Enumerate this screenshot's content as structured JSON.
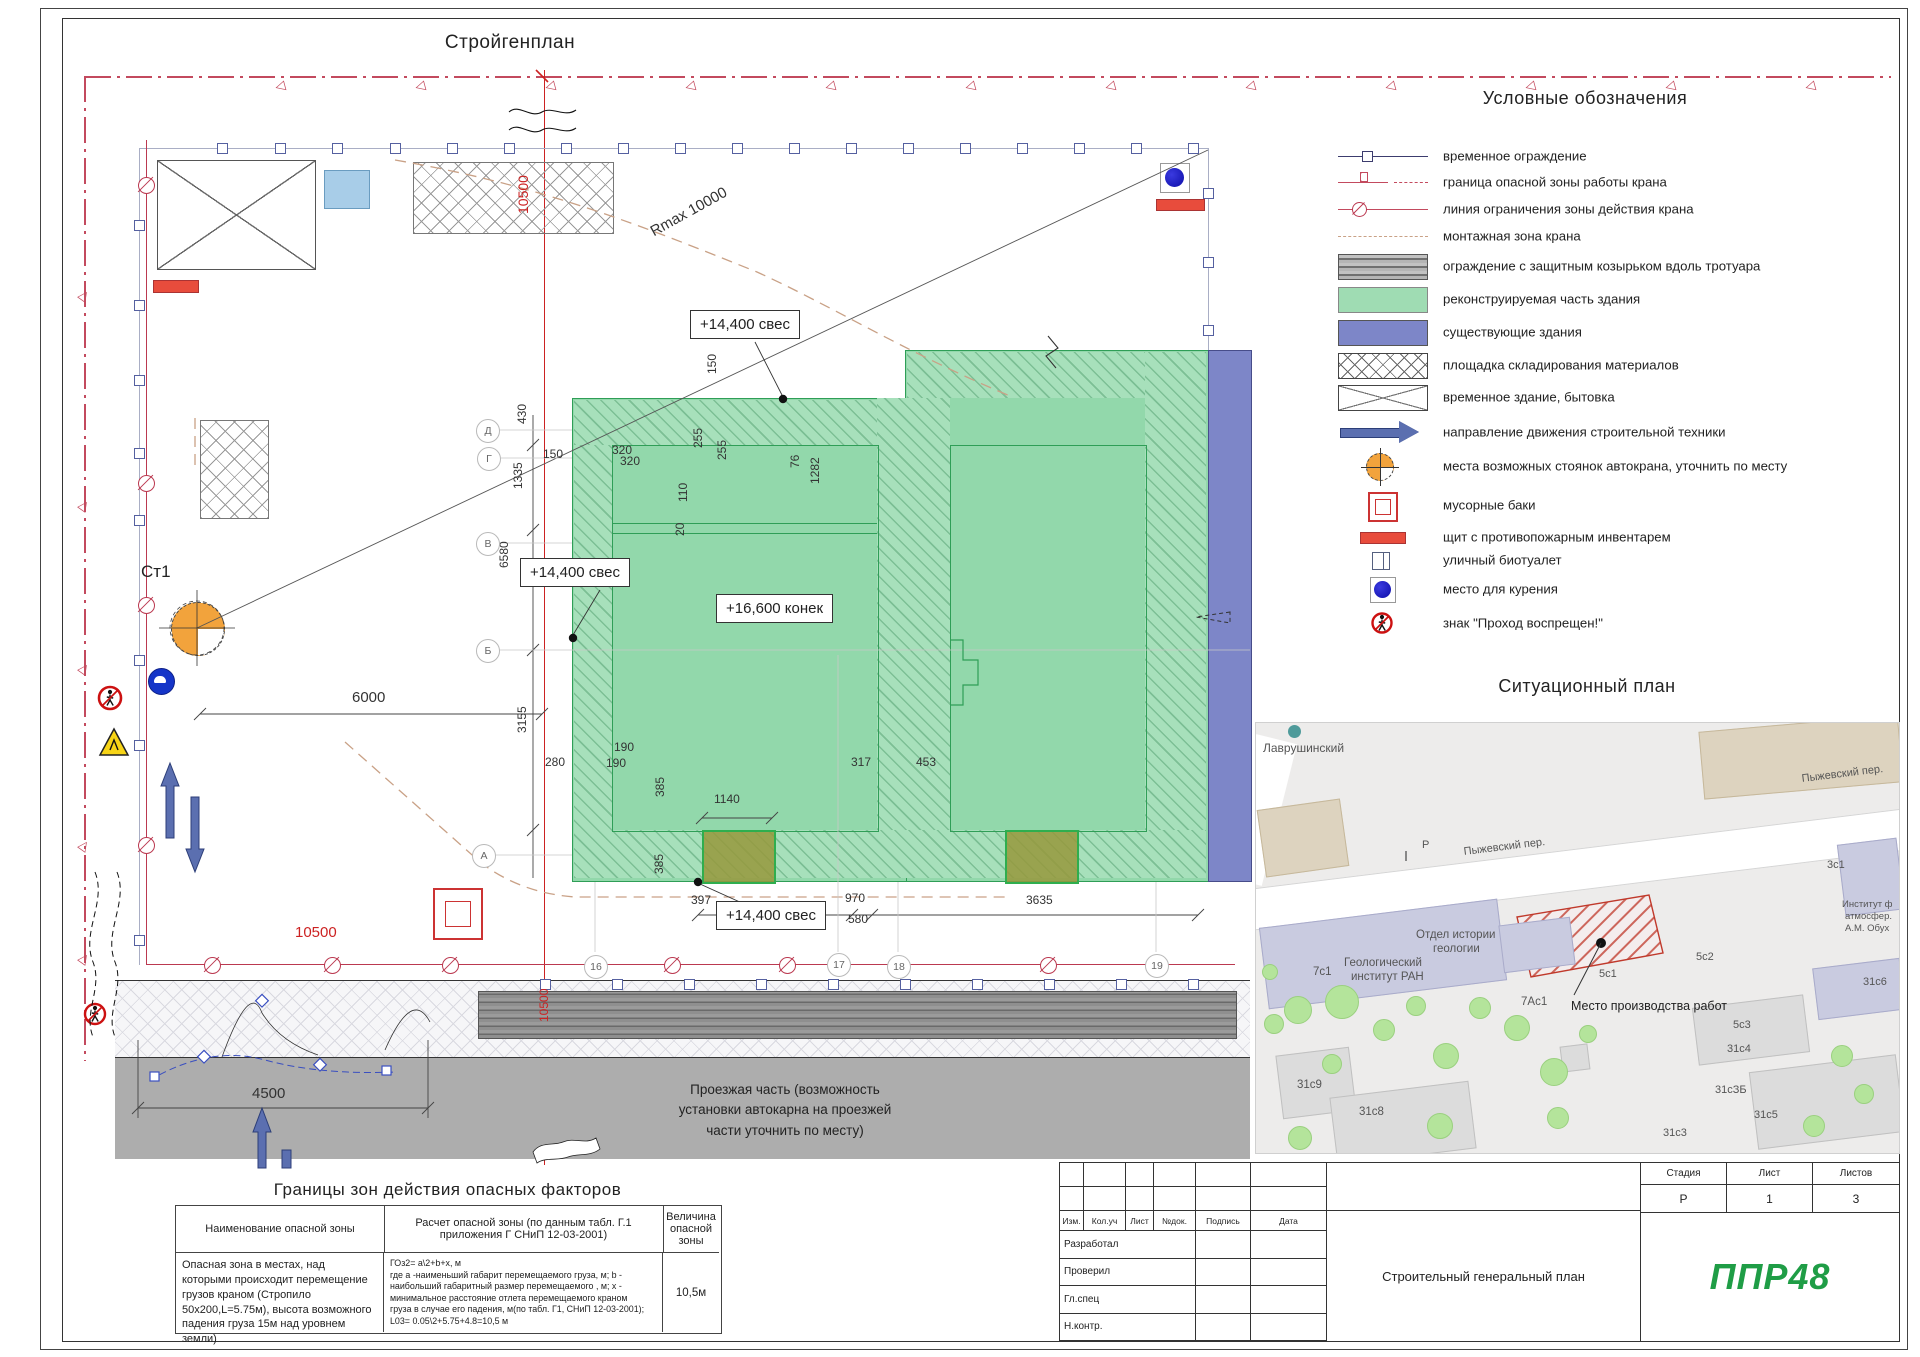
{
  "titles": {
    "plan": "Стройгенплан",
    "legend": "Условные обозначения",
    "situational": "Ситуационный план",
    "hazard": "Границы зон действия опасных факторов"
  },
  "legend": {
    "items": [
      {
        "icon": "fence-line",
        "label": "временное ограждение",
        "y": 8,
        "h": 20
      },
      {
        "icon": "danger-boundary-line",
        "label": "граница опасной зоны работы крана",
        "y": 34,
        "h": 20
      },
      {
        "icon": "crane-limit-line",
        "label": "линия ограничения зоны действия крана",
        "y": 61,
        "h": 20
      },
      {
        "icon": "montage-zone-line",
        "label": "монтажная зона крана",
        "y": 88,
        "h": 20
      },
      {
        "icon": "hoarding",
        "label": "ограждение с защитным козырьком вдоль тротуара",
        "y": 116,
        "h": 24
      },
      {
        "icon": "reconstruction",
        "label": "реконструируемая часть здания",
        "y": 149,
        "h": 24
      },
      {
        "icon": "existing",
        "label": "существующие здания",
        "y": 182,
        "h": 24
      },
      {
        "icon": "storage",
        "label": "площадка складирования материалов",
        "y": 215,
        "h": 24
      },
      {
        "icon": "tempbuilding",
        "label": "временное здание, бытовка",
        "y": 247,
        "h": 24
      },
      {
        "icon": "arrow",
        "label": "направление движения строительной техники",
        "y": 282,
        "h": 24
      },
      {
        "icon": "crane-parking",
        "label": "места возможных стоянок автокрана, уточнить по месту",
        "y": 312,
        "h": 32
      },
      {
        "icon": "trash",
        "label": "мусорные баки",
        "y": 350,
        "h": 34
      },
      {
        "icon": "fire-shield",
        "label": "щит с противопожарным инвентарем",
        "y": 390,
        "h": 18
      },
      {
        "icon": "biotoilet",
        "label": "уличный биотуалет",
        "y": 412,
        "h": 20
      },
      {
        "icon": "smoking",
        "label": "место для курения",
        "y": 438,
        "h": 26
      },
      {
        "icon": "no-pass",
        "label": "знак \"Проход воспрещен!\"",
        "y": 472,
        "h": 26
      }
    ]
  },
  "plan": {
    "crane_label": "Ст1",
    "radius_label": "Rmax 10000",
    "levels": [
      "+14,400 свес",
      "+14,400 свес",
      "+16,600 конек",
      "+14,400 свес"
    ],
    "road_note": "Проезжая часть (возможность\nустановки автокарна на проезжей\nчасти уточнить по месту)",
    "labels": [
      {
        "t": "430",
        "x": 516,
        "y": 424,
        "r": -90
      },
      {
        "t": "1335",
        "x": 512,
        "y": 489,
        "r": -90
      },
      {
        "t": "6580",
        "x": 498,
        "y": 568,
        "r": -90
      },
      {
        "t": "1640",
        "x": 520,
        "y": 585,
        "r": -90
      },
      {
        "t": "3155",
        "x": 516,
        "y": 733,
        "r": -90
      },
      {
        "t": "150",
        "x": 543,
        "y": 448
      },
      {
        "t": "150",
        "x": 706,
        "y": 374,
        "r": -90
      },
      {
        "t": "320",
        "x": 612,
        "y": 444
      },
      {
        "t": "320",
        "x": 620,
        "y": 455
      },
      {
        "t": "255",
        "x": 692,
        "y": 448,
        "r": -90
      },
      {
        "t": "255",
        "x": 716,
        "y": 460,
        "r": -90
      },
      {
        "t": "110",
        "x": 677,
        "y": 502,
        "r": -90
      },
      {
        "t": "20",
        "x": 674,
        "y": 536,
        "r": -90
      },
      {
        "t": "76",
        "x": 789,
        "y": 468,
        "r": -90
      },
      {
        "t": "1282",
        "x": 809,
        "y": 484,
        "r": -90
      },
      {
        "t": "280",
        "x": 545,
        "y": 756
      },
      {
        "t": "190",
        "x": 614,
        "y": 741
      },
      {
        "t": "190",
        "x": 606,
        "y": 757
      },
      {
        "t": "385",
        "x": 654,
        "y": 797,
        "r": -90
      },
      {
        "t": "385",
        "x": 653,
        "y": 874,
        "r": -90
      },
      {
        "t": "1140",
        "x": 714,
        "y": 793
      },
      {
        "t": "317",
        "x": 851,
        "y": 756
      },
      {
        "t": "453",
        "x": 916,
        "y": 756
      },
      {
        "t": "397",
        "x": 691,
        "y": 894
      },
      {
        "t": "970",
        "x": 845,
        "y": 892
      },
      {
        "t": "3635",
        "x": 1026,
        "y": 894
      },
      {
        "t": "580",
        "x": 848,
        "y": 913
      },
      {
        "t": "6000",
        "x": 352,
        "y": 690,
        "cls": "d15"
      },
      {
        "t": "4500",
        "x": 252,
        "y": 1086,
        "cls": "d15"
      },
      {
        "t": "10500",
        "x": 295,
        "y": 925,
        "cls": "red d15"
      },
      {
        "t": "10500",
        "x": 516,
        "y": 214,
        "r": -90,
        "cls": "red d14"
      },
      {
        "t": "10500",
        "x": 538,
        "y": 1022,
        "r": -90,
        "cls": "red"
      },
      {
        "t": "Rmax 10000",
        "x": 648,
        "y": 226,
        "r": -29,
        "cls": "d15"
      },
      {
        "t": "Ст1",
        "x": 141,
        "y": 563,
        "cls": "d17"
      }
    ],
    "grid_letters": [
      {
        "t": "Д",
        "x": 487,
        "y": 430
      },
      {
        "t": "Г",
        "x": 488,
        "y": 458
      },
      {
        "t": "В",
        "x": 487,
        "y": 543
      },
      {
        "t": "Б",
        "x": 487,
        "y": 650
      },
      {
        "t": "А",
        "x": 483,
        "y": 855
      }
    ],
    "grid_numbers": [
      {
        "t": "16",
        "x": 595,
        "y": 966
      },
      {
        "t": "17",
        "x": 838,
        "y": 964
      },
      {
        "t": "18",
        "x": 898,
        "y": 966
      },
      {
        "t": "19",
        "x": 1156,
        "y": 965
      }
    ],
    "deco": {
      "top_flags": [
        275,
        415,
        545,
        685,
        825,
        965,
        1105,
        1245,
        1385,
        1525,
        1665,
        1805
      ],
      "left_flags": [
        290,
        500,
        663,
        840,
        953
      ],
      "fence_top_x": [
        222,
        280,
        337,
        395,
        452,
        509,
        566,
        623,
        680,
        737,
        794,
        851,
        908,
        965,
        1022,
        1079,
        1136,
        1193
      ],
      "fence_right_y": [
        193,
        262,
        330
      ],
      "fence_left_y": [
        225,
        305,
        380,
        453,
        520,
        660,
        745,
        940
      ],
      "strip_sq_x": [
        545,
        617,
        689,
        761,
        833,
        905,
        977,
        1049,
        1121,
        1193
      ],
      "limit_circ_left_y": [
        185,
        483,
        605,
        845
      ],
      "limit_circ_bottom_x": [
        212,
        332,
        450,
        672,
        787,
        1048
      ]
    }
  },
  "map": {
    "labels": [
      {
        "t": "Лаврушинский",
        "x": 7,
        "y": 18,
        "s": 12
      },
      {
        "t": "Пыжевский пер.",
        "x": 207,
        "y": 123,
        "s": 11,
        "r": -7
      },
      {
        "t": "Пыжевский пер.",
        "x": 545,
        "y": 50,
        "s": 11,
        "r": -7
      },
      {
        "t": "P",
        "x": 166,
        "y": 116,
        "s": 11
      },
      {
        "t": "3с1",
        "x": 571,
        "y": 136,
        "s": 11
      },
      {
        "t": "Институт ф",
        "x": 586,
        "y": 176,
        "s": 9.5
      },
      {
        "t": "атмосфер.",
        "x": 589,
        "y": 188,
        "s": 9.5
      },
      {
        "t": "А.М. Обух",
        "x": 589,
        "y": 200,
        "s": 9.5
      },
      {
        "t": "Отдел истории",
        "x": 160,
        "y": 206,
        "s": 11.5
      },
      {
        "t": "геологии",
        "x": 177,
        "y": 220,
        "s": 11.5
      },
      {
        "t": "7с1",
        "x": 57,
        "y": 243,
        "s": 11.5
      },
      {
        "t": "Геологический",
        "x": 88,
        "y": 234,
        "s": 11.5
      },
      {
        "t": "институт РАН",
        "x": 95,
        "y": 248,
        "s": 11.5
      },
      {
        "t": "7Ас1",
        "x": 265,
        "y": 273,
        "s": 11.5
      },
      {
        "t": "5с2",
        "x": 440,
        "y": 228,
        "s": 11
      },
      {
        "t": "5с1",
        "x": 343,
        "y": 245,
        "s": 11
      },
      {
        "t": "Место производства работ",
        "x": 315,
        "y": 276,
        "s": 12.5,
        "dark": 1
      },
      {
        "t": "5с3",
        "x": 477,
        "y": 296,
        "s": 11
      },
      {
        "t": "31с4",
        "x": 471,
        "y": 320,
        "s": 11
      },
      {
        "t": "31с6",
        "x": 607,
        "y": 253,
        "s": 11
      },
      {
        "t": "31сЗБ",
        "x": 459,
        "y": 361,
        "s": 11
      },
      {
        "t": "31с5",
        "x": 498,
        "y": 386,
        "s": 11
      },
      {
        "t": "31с3",
        "x": 407,
        "y": 404,
        "s": 11
      },
      {
        "t": "31с9",
        "x": 41,
        "y": 356,
        "s": 11.5
      },
      {
        "t": "31с8",
        "x": 103,
        "y": 383,
        "s": 11.5
      }
    ],
    "trees": [
      [
        17,
        300,
        9
      ],
      [
        41,
        286,
        13
      ],
      [
        85,
        278,
        16
      ],
      [
        127,
        306,
        10
      ],
      [
        159,
        282,
        9
      ],
      [
        189,
        332,
        12
      ],
      [
        223,
        284,
        10
      ],
      [
        260,
        304,
        12
      ],
      [
        297,
        348,
        13
      ],
      [
        183,
        402,
        12
      ],
      [
        301,
        394,
        10
      ],
      [
        43,
        414,
        11
      ],
      [
        75,
        340,
        9
      ],
      [
        331,
        310,
        8
      ],
      [
        585,
        332,
        10
      ],
      [
        607,
        370,
        9
      ],
      [
        557,
        402,
        10
      ],
      [
        13,
        248,
        7
      ]
    ],
    "buildings": [
      {
        "x": 5,
        "y": 81,
        "w": 82,
        "h": 66,
        "r": -8,
        "k": "mb-beige"
      },
      {
        "x": 445,
        "y": 0,
        "w": 198,
        "h": 66,
        "r": -5,
        "k": "mb-beige"
      },
      {
        "x": 7,
        "y": 190,
        "w": 238,
        "h": 80,
        "r": -7,
        "k": "mb-lav"
      },
      {
        "x": 245,
        "y": 198,
        "w": 70,
        "h": 46,
        "r": -7,
        "k": "mb-lav"
      },
      {
        "x": 585,
        "y": 118,
        "w": 58,
        "h": 70,
        "r": -7,
        "k": "mb-lav"
      },
      {
        "x": 559,
        "y": 240,
        "w": 86,
        "h": 50,
        "r": -7,
        "k": "mb-lav"
      },
      {
        "x": 439,
        "y": 278,
        "w": 110,
        "h": 56,
        "r": -7,
        "k": "mb-gray"
      },
      {
        "x": 497,
        "y": 340,
        "w": 146,
        "h": 76,
        "r": -7,
        "k": "mb-gray"
      },
      {
        "x": 23,
        "y": 328,
        "w": 72,
        "h": 62,
        "r": -7,
        "k": "mb-gray"
      },
      {
        "x": 77,
        "y": 366,
        "w": 138,
        "h": 66,
        "r": -7,
        "k": "mb-gray"
      },
      {
        "x": 305,
        "y": 322,
        "w": 26,
        "h": 24,
        "r": -7,
        "k": "mb-gray"
      }
    ]
  },
  "hazard_table": {
    "headers": [
      "Наименование опасной зоны",
      "Расчет опасной зоны (по данным табл. Г.1\nприложения Г СНиП 12-03-2001)",
      "Величина\nопасной\nзоны"
    ],
    "row": {
      "name": "Опасная зона в местах, над которыми происходит перемещение грузов краном (Стропило 50х200,L=5.75м), высота возможного падения груза 15м над уровнем земли)",
      "calc": "ГОз2= а\\2+b+х, м\nгде а -наименьший габарит перемещаемого груза, м; b -\nнаибольший габаритный размер перемещаемого , м; х -\nминимальное расстояние отлета перемещаемого краном\nгруза в случае его падения, м(по табл. Г1, СНиП 12-03-2001);\nL03= 0.05\\2+5.75+4.8=10,5 м",
      "value": "10,5м"
    }
  },
  "stamp": {
    "header_cols": [
      "Изм.",
      "Кол.уч",
      "Лист",
      "№док.",
      "Подпись",
      "Дата"
    ],
    "roles": [
      "Разработал",
      "Проверил",
      "Гл.спец",
      "Н.контр."
    ],
    "stage_headers": [
      "Стадия",
      "Лист",
      "Листов"
    ],
    "stage_values": [
      "Р",
      "1",
      "3"
    ],
    "doc_title": "Строительный генеральный план",
    "logo": "ППР48"
  },
  "colors": {
    "accent_red": "#cc2222",
    "boundary": "#c34a5e",
    "limit_line": "#bb3950",
    "green_fill": "#92d8ab",
    "existing_blue": "#7d86c8",
    "orange": "#f2a33c",
    "logo_green": "#1f9d46"
  }
}
